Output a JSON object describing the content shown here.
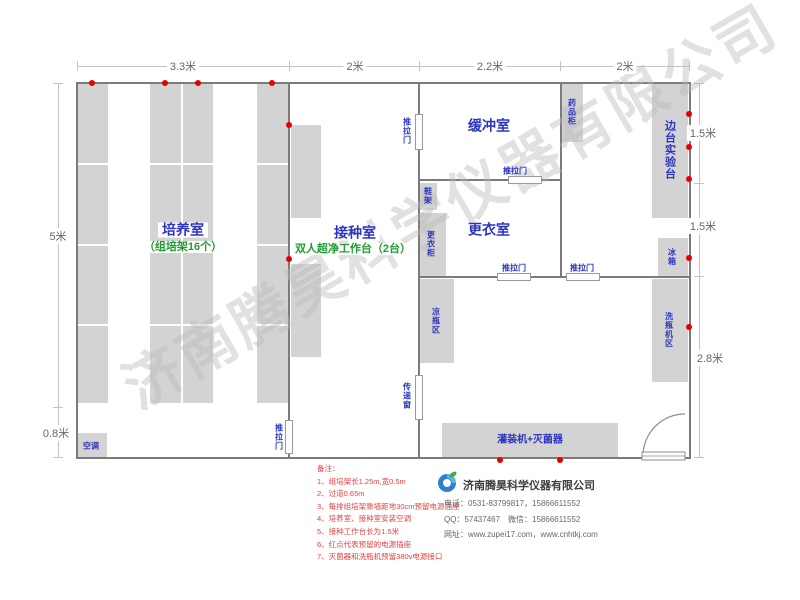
{
  "watermark": "济南腾昊科学仪器有限公司",
  "dimensions": {
    "top": [
      "3.3米",
      "2米",
      "2.2米",
      "2米"
    ],
    "left": [
      "5米",
      "0.8米"
    ],
    "right": [
      "1.5米",
      "1.5米",
      "2.8米"
    ]
  },
  "rooms": {
    "cultivation": {
      "name": "培养室",
      "subtitle": "（组培架16个）"
    },
    "inoculation": {
      "name": "接种室",
      "subtitle": "双人超净工作台（2台）"
    },
    "buffer": {
      "name": "缓冲室"
    },
    "dressing": {
      "name": "更衣室"
    }
  },
  "labels": {
    "sliding_door": "推拉门",
    "transfer_window": "传递窗",
    "shoe_rack": "鞋架",
    "wardrobe": "更衣柜",
    "bottle_cooling": "凉瓶区",
    "medicine_cabinet": "药品柜",
    "side_bench": "边台实验台",
    "fridge": "冰箱",
    "bottle_washer": "洗瓶机区",
    "filling_sterilizer": "灌装机+灭菌器",
    "air_conditioner": "空调"
  },
  "notes": {
    "title": "备注：",
    "items": [
      "1、组培架长1.25m,宽0.5m",
      "2、过道0.65m",
      "3、每排组培架靠墙距地30cm预留电源插座",
      "4、培养室、接种室安装空调",
      "5、接种工作台长为1.5米",
      "6、红点代表预留的电源插座",
      "7、灭菌器和洗瓶机预留380v电源接口"
    ]
  },
  "company": {
    "name": "济南腾昊科学仪器有限公司",
    "phone": "电话：0531-83799817，15866611552",
    "qq": "QQ：57437467　微信：15866611552",
    "website": "网址：www.zupei17.com，www.cnhtkj.com"
  },
  "colors": {
    "wall": "#7b7b7b",
    "block": "#d3d3d3",
    "label_blue": "#2b35c0",
    "label_green": "#1e9e32",
    "socket_red": "#e60000"
  }
}
